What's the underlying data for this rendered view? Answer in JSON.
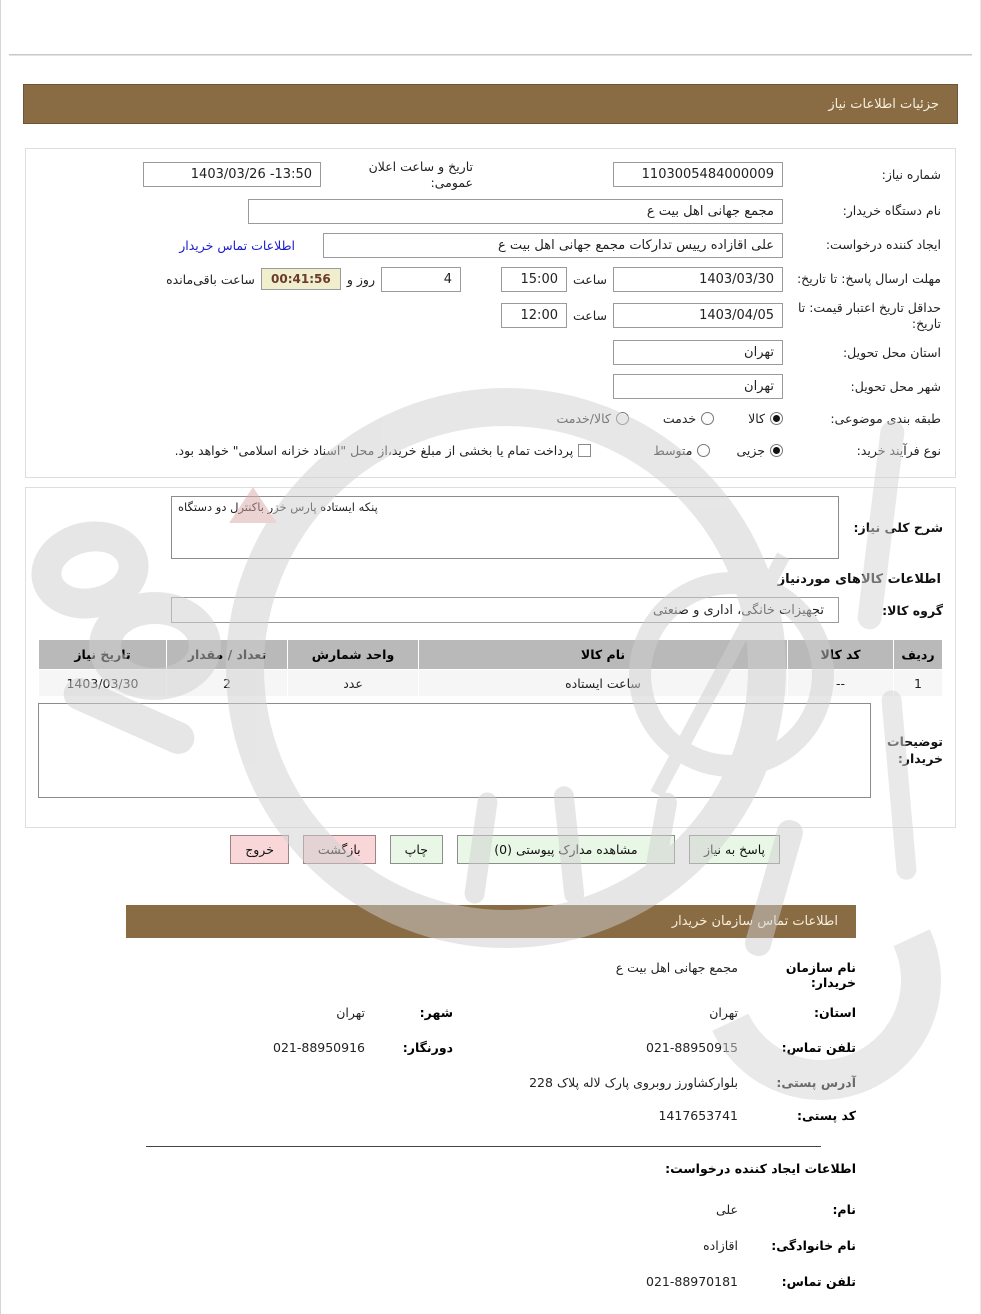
{
  "colors": {
    "header_brown": "#8a6c44",
    "link_blue": "#1a1acd",
    "timer_bg": "#f0eecd",
    "timer_text": "#6b3a2a",
    "button_green": "#e9f8e6",
    "button_pink": "#f9d7d8",
    "table_header_gray": "#b9b9b9"
  },
  "bars": {
    "details_title": "جزئیات اطلاعات نیاز",
    "contact_title": "اطلاعات تماس سازمان خریدار"
  },
  "form": {
    "need_number": {
      "label": "شماره نیاز:",
      "value": "1103005484000009"
    },
    "announce": {
      "label": "تاریخ و ساعت اعلان عمومی:",
      "value": "1403/03/26 -13:50"
    },
    "buyer_device": {
      "label": "نام دستگاه خریدار:",
      "value": "مجمع جهانی اهل بیت ع"
    },
    "creator": {
      "label": "ایجاد کننده درخواست:",
      "value": "علی اقازاده رییس تدارکات مجمع جهانی اهل بیت ع",
      "link": "اطلاعات تماس خریدار"
    },
    "deadline": {
      "label": "مهلت ارسال پاسخ: تا تاریخ:",
      "date": "1403/03/30",
      "hour_label": "ساعت",
      "time": "15:00",
      "days": "4",
      "days_label": "روز و",
      "countdown": "00:41:56",
      "remaining_label": "ساعت باقی‌مانده"
    },
    "price_validity": {
      "label": "حداقل تاریخ اعتبار قیمت: تا تاریخ:",
      "date": "1403/04/05",
      "hour_label": "ساعت",
      "time": "12:00"
    },
    "province": {
      "label": "استان محل تحویل:",
      "value": "تهران"
    },
    "city": {
      "label": "شهر محل تحویل:",
      "value": "تهران"
    },
    "subject_class": {
      "label": "طبقه بندی موضوعی:",
      "options": [
        "کالا",
        "خدمت",
        "کالا/خدمت"
      ],
      "selected": "کالا"
    },
    "process_type": {
      "label": "نوع فرآیند خرید:",
      "options": [
        "جزیی",
        "متوسط"
      ],
      "selected": "جزیی",
      "checkbox_label": "پرداخت تمام یا بخشی از مبلغ خرید،از محل \"اسناد خزانه اسلامی\" خواهد بود."
    }
  },
  "need_desc": {
    "label": "شرح کلی نیاز:",
    "value": "پنکه ایستاده پارس خزر باکنترل دو دستگاه"
  },
  "goods": {
    "heading": "اطلاعات کالاهای موردنیاز",
    "group": {
      "label": "گروه کالا:",
      "value": "تجهیزات خانگی، اداری و صنعتی"
    },
    "table": {
      "headers": [
        "ردیف",
        "کد کالا",
        "نام کالا",
        "واحد شمارش",
        "تعداد / مقدار",
        "تاریخ نیاز"
      ],
      "rows": [
        [
          "1",
          "--",
          "ساعت ایستاده",
          "عدد",
          "2",
          "1403/03/30"
        ]
      ]
    }
  },
  "comments": {
    "label": "توضیحات خریدار:",
    "value": ""
  },
  "buttons": {
    "reply": "پاسخ به نیاز",
    "attachments": "مشاهده مدارک پیوستی (0)",
    "print": "چاپ",
    "back": "بازگشت",
    "exit": "خروج"
  },
  "contact": {
    "org_name": {
      "label": "نام سازمان خریدار:",
      "value": "مجمع جهانی اهل بیت  ع"
    },
    "province": {
      "label": "استان:",
      "value": "تهران"
    },
    "city": {
      "label": "شهر:",
      "value": "تهران"
    },
    "phone": {
      "label": "تلفن تماس:",
      "value": "021-88950915"
    },
    "fax": {
      "label": "دورنگار:",
      "value": "021-88950916"
    },
    "address": {
      "label": "آدرس پستی:",
      "value": "بلوارکشاورز روبروی پارک لاله  پلاک 228"
    },
    "postal_code": {
      "label": "کد پستی:",
      "value": "1417653741"
    },
    "creator_heading": "اطلاعات ایجاد کننده درخواست:",
    "first_name": {
      "label": "نام:",
      "value": "علی"
    },
    "last_name": {
      "label": "نام خانوادگی:",
      "value": "اقازاده"
    },
    "creator_phone": {
      "label": "تلفن تماس:",
      "value": "021-88970181"
    }
  }
}
